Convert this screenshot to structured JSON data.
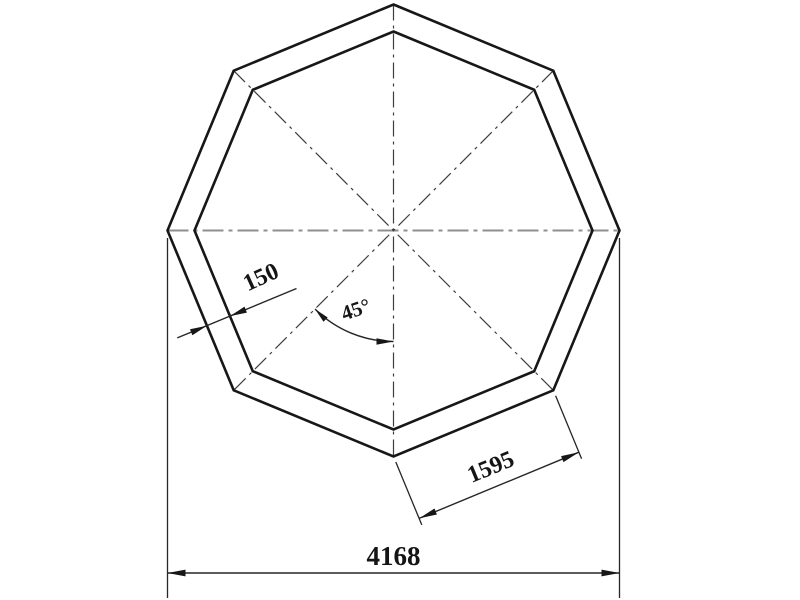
{
  "drawing": {
    "type": "engineering-drawing",
    "shape": "double-walled regular octagon, vertex-up, with center lines",
    "labels": {
      "wall_thickness": "150",
      "angle": "45°",
      "side_length": "1595",
      "overall_width": "4168"
    },
    "colors": {
      "outline": "#171717",
      "dimension": "#262626",
      "centerline_horizontal": "#8f8f8f",
      "centerline_dark": "#3d3d3d",
      "background": "#ffffff"
    }
  }
}
